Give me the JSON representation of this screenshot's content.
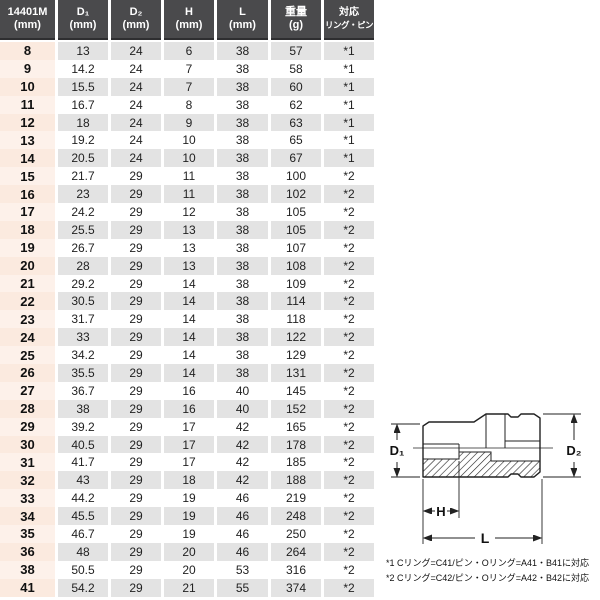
{
  "table": {
    "header": {
      "columns": [
        {
          "line1": "14401M",
          "line2": "(mm)"
        },
        {
          "line1": "D₁",
          "line2": "(mm)"
        },
        {
          "line1": "D₂",
          "line2": "(mm)"
        },
        {
          "line1": "H",
          "line2": "(mm)"
        },
        {
          "line1": "L",
          "line2": "(mm)"
        },
        {
          "line1": "重量",
          "line2": "(g)"
        },
        {
          "line1": "対応",
          "line2": "リング・ピン"
        }
      ]
    },
    "rows": [
      [
        "8",
        "13",
        "24",
        "6",
        "38",
        "57",
        "*1"
      ],
      [
        "9",
        "14.2",
        "24",
        "7",
        "38",
        "58",
        "*1"
      ],
      [
        "10",
        "15.5",
        "24",
        "7",
        "38",
        "60",
        "*1"
      ],
      [
        "11",
        "16.7",
        "24",
        "8",
        "38",
        "62",
        "*1"
      ],
      [
        "12",
        "18",
        "24",
        "9",
        "38",
        "63",
        "*1"
      ],
      [
        "13",
        "19.2",
        "24",
        "10",
        "38",
        "65",
        "*1"
      ],
      [
        "14",
        "20.5",
        "24",
        "10",
        "38",
        "67",
        "*1"
      ],
      [
        "15",
        "21.7",
        "29",
        "11",
        "38",
        "100",
        "*2"
      ],
      [
        "16",
        "23",
        "29",
        "11",
        "38",
        "102",
        "*2"
      ],
      [
        "17",
        "24.2",
        "29",
        "12",
        "38",
        "105",
        "*2"
      ],
      [
        "18",
        "25.5",
        "29",
        "13",
        "38",
        "105",
        "*2"
      ],
      [
        "19",
        "26.7",
        "29",
        "13",
        "38",
        "107",
        "*2"
      ],
      [
        "20",
        "28",
        "29",
        "13",
        "38",
        "108",
        "*2"
      ],
      [
        "21",
        "29.2",
        "29",
        "14",
        "38",
        "109",
        "*2"
      ],
      [
        "22",
        "30.5",
        "29",
        "14",
        "38",
        "114",
        "*2"
      ],
      [
        "23",
        "31.7",
        "29",
        "14",
        "38",
        "118",
        "*2"
      ],
      [
        "24",
        "33",
        "29",
        "14",
        "38",
        "122",
        "*2"
      ],
      [
        "25",
        "34.2",
        "29",
        "14",
        "38",
        "129",
        "*2"
      ],
      [
        "26",
        "35.5",
        "29",
        "14",
        "38",
        "131",
        "*2"
      ],
      [
        "27",
        "36.7",
        "29",
        "16",
        "40",
        "145",
        "*2"
      ],
      [
        "28",
        "38",
        "29",
        "16",
        "40",
        "152",
        "*2"
      ],
      [
        "29",
        "39.2",
        "29",
        "17",
        "42",
        "165",
        "*2"
      ],
      [
        "30",
        "40.5",
        "29",
        "17",
        "42",
        "178",
        "*2"
      ],
      [
        "31",
        "41.7",
        "29",
        "17",
        "42",
        "185",
        "*2"
      ],
      [
        "32",
        "43",
        "29",
        "18",
        "42",
        "188",
        "*2"
      ],
      [
        "33",
        "44.2",
        "29",
        "19",
        "46",
        "219",
        "*2"
      ],
      [
        "34",
        "45.5",
        "29",
        "19",
        "46",
        "248",
        "*2"
      ],
      [
        "35",
        "46.7",
        "29",
        "19",
        "46",
        "250",
        "*2"
      ],
      [
        "36",
        "48",
        "29",
        "20",
        "46",
        "264",
        "*2"
      ],
      [
        "38",
        "50.5",
        "29",
        "20",
        "53",
        "316",
        "*2"
      ],
      [
        "41",
        "54.2",
        "29",
        "21",
        "55",
        "374",
        "*2"
      ]
    ]
  },
  "diagram": {
    "label_d1": "D₁",
    "label_d2": "D₂",
    "label_h": "H",
    "label_l": "L"
  },
  "footnotes": {
    "note1": "*1 Cリング=C41/ピン・Oリング=A41・B41に対応",
    "note2": "*2 Cリング=C42/ピン・Oリング=A42・B42に対応"
  },
  "colors": {
    "header_bg": "#4a4a4c",
    "stripe_gray": "#e3e3e3",
    "size_column_pink": "#fdf1ea"
  }
}
